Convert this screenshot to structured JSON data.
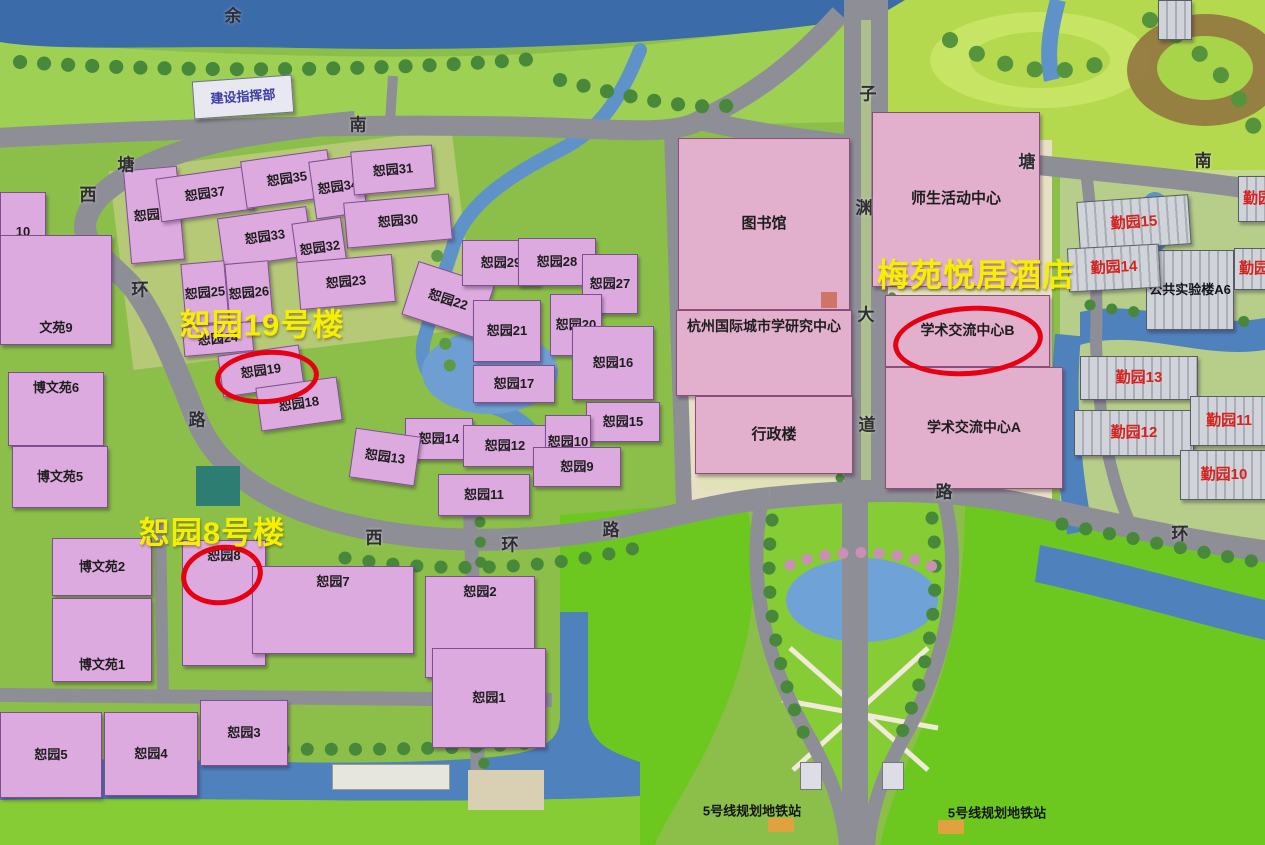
{
  "map": {
    "colors": {
      "highlight_text": "#f7ef00",
      "circle_stroke": "#e60012",
      "qinyuan_label": "#d6231f",
      "blue_label": "#3d3da8",
      "building_pink": "#dcaade",
      "building_civic": "#e2afcd",
      "water": "#4a7ab5",
      "road": "#8e8e96",
      "lawn": "#6cc81e"
    },
    "annotations": {
      "highlights": [
        {
          "n": "highlight-shuyuan-19-building",
          "t": "恕园19号楼",
          "x": 262,
          "y": 322,
          "fs": 31
        },
        {
          "n": "highlight-shuyuan-8-building",
          "t": "恕园8号楼",
          "x": 212,
          "y": 530,
          "fs": 31
        },
        {
          "n": "highlight-meiyuan-yueju-hotel",
          "t": "梅苑悦居酒店",
          "x": 976,
          "y": 273,
          "fs": 32
        }
      ],
      "circles": [
        {
          "n": "circle-shuyuan-19",
          "cx": 262,
          "cy": 372,
          "rx": 47,
          "ry": 22,
          "r": -4
        },
        {
          "n": "circle-shuyuan-8",
          "cx": 217,
          "cy": 570,
          "rx": 36,
          "ry": 25,
          "r": -8
        },
        {
          "n": "circle-academic-exchange-center-b",
          "cx": 963,
          "cy": 336,
          "rx": 70,
          "ry": 30,
          "r": -4
        }
      ]
    },
    "buildings": [
      {
        "n": "jianshe-zhihuibu",
        "l": "建设指挥部",
        "x": 193,
        "y": 78,
        "w": 100,
        "h": 38,
        "r": -4,
        "s": "white",
        "lc": "#3d3da8",
        "fs": 13
      },
      {
        "n": "shuyuan-36",
        "l": "恕园36",
        "x": 127,
        "y": 168,
        "w": 54,
        "h": 94,
        "r": -5,
        "s": "pink"
      },
      {
        "n": "shuyuan-37",
        "l": "恕园37",
        "x": 158,
        "y": 172,
        "w": 94,
        "h": 44,
        "r": -8,
        "s": "pink"
      },
      {
        "n": "shuyuan-35",
        "l": "恕园35",
        "x": 243,
        "y": 155,
        "w": 88,
        "h": 48,
        "r": -8,
        "s": "pink"
      },
      {
        "n": "shuyuan-34",
        "l": "恕园34",
        "x": 312,
        "y": 158,
        "w": 52,
        "h": 58,
        "r": -8,
        "s": "pink"
      },
      {
        "n": "shuyuan-31",
        "l": "恕园31",
        "x": 352,
        "y": 148,
        "w": 82,
        "h": 44,
        "r": -5,
        "s": "pink"
      },
      {
        "n": "shuyuan-30",
        "l": "恕园30",
        "x": 345,
        "y": 198,
        "w": 106,
        "h": 46,
        "r": -5,
        "s": "pink"
      },
      {
        "n": "shuyuan-33",
        "l": "恕园33",
        "x": 220,
        "y": 212,
        "w": 90,
        "h": 50,
        "r": -8,
        "s": "pink"
      },
      {
        "n": "shuyuan-32",
        "l": "恕园32",
        "x": 295,
        "y": 220,
        "w": 50,
        "h": 56,
        "r": -8,
        "s": "pink"
      },
      {
        "n": "shuyuan-25",
        "l": "恕园25",
        "x": 183,
        "y": 262,
        "w": 44,
        "h": 62,
        "r": -5,
        "s": "pink"
      },
      {
        "n": "shuyuan-26",
        "l": "恕园26",
        "x": 227,
        "y": 262,
        "w": 44,
        "h": 62,
        "r": -5,
        "s": "pink"
      },
      {
        "n": "shuyuan-23",
        "l": "恕园23",
        "x": 298,
        "y": 258,
        "w": 96,
        "h": 48,
        "r": -5,
        "s": "pink"
      },
      {
        "n": "shuyuan-22",
        "l": "恕园22",
        "x": 408,
        "y": 272,
        "w": 80,
        "h": 56,
        "r": 18,
        "s": "pink"
      },
      {
        "n": "shuyuan-24",
        "l": "恕园24",
        "x": 183,
        "y": 324,
        "w": 70,
        "h": 30,
        "r": -5,
        "s": "pink"
      },
      {
        "n": "shuyuan-19",
        "l": "恕园19",
        "x": 220,
        "y": 350,
        "w": 82,
        "h": 42,
        "r": -8,
        "s": "pink"
      },
      {
        "n": "shuyuan-18",
        "l": "恕园18",
        "x": 258,
        "y": 382,
        "w": 82,
        "h": 44,
        "r": -8,
        "s": "pink"
      },
      {
        "n": "shuyuan-29",
        "l": "恕园29",
        "x": 462,
        "y": 240,
        "w": 78,
        "h": 46,
        "r": 0,
        "s": "pink"
      },
      {
        "n": "shuyuan-28",
        "l": "恕园28",
        "x": 518,
        "y": 238,
        "w": 78,
        "h": 48,
        "r": 0,
        "s": "pink"
      },
      {
        "n": "shuyuan-27",
        "l": "恕园27",
        "x": 582,
        "y": 254,
        "w": 56,
        "h": 60,
        "r": 0,
        "s": "pink"
      },
      {
        "n": "shuyuan-21",
        "l": "恕园21",
        "x": 473,
        "y": 300,
        "w": 68,
        "h": 62,
        "r": 0,
        "s": "pink"
      },
      {
        "n": "shuyuan-20",
        "l": "恕园20",
        "x": 550,
        "y": 294,
        "w": 52,
        "h": 62,
        "r": 0,
        "s": "pink"
      },
      {
        "n": "shuyuan-16",
        "l": "恕园16",
        "x": 572,
        "y": 326,
        "w": 82,
        "h": 74,
        "r": 0,
        "s": "pink"
      },
      {
        "n": "shuyuan-17",
        "l": "恕园17",
        "x": 473,
        "y": 365,
        "w": 82,
        "h": 38,
        "r": 0,
        "s": "pink"
      },
      {
        "n": "shuyuan-15",
        "l": "恕园15",
        "x": 586,
        "y": 402,
        "w": 74,
        "h": 40,
        "r": 0,
        "s": "pink"
      },
      {
        "n": "shuyuan-14",
        "l": "恕园14",
        "x": 405,
        "y": 418,
        "w": 68,
        "h": 42,
        "r": 0,
        "s": "pink"
      },
      {
        "n": "shuyuan-13",
        "l": "恕园13",
        "x": 352,
        "y": 432,
        "w": 66,
        "h": 50,
        "r": 8,
        "s": "pink"
      },
      {
        "n": "shuyuan-12",
        "l": "恕园12",
        "x": 463,
        "y": 425,
        "w": 84,
        "h": 42,
        "r": 0,
        "s": "pink"
      },
      {
        "n": "shuyuan-10",
        "l": "恕园10",
        "x": 545,
        "y": 415,
        "w": 46,
        "h": 54,
        "r": 0,
        "s": "pink"
      },
      {
        "n": "shuyuan-9",
        "l": "恕园9",
        "x": 533,
        "y": 447,
        "w": 88,
        "h": 40,
        "r": 0,
        "s": "pink"
      },
      {
        "n": "shuyuan-11",
        "l": "恕园11",
        "x": 438,
        "y": 474,
        "w": 92,
        "h": 42,
        "r": 0,
        "s": "pink"
      },
      {
        "n": "bowenyuan-10-partial",
        "l": "10",
        "x": 0,
        "y": 192,
        "w": 46,
        "h": 80,
        "r": 0,
        "s": "pink"
      },
      {
        "n": "bowenyuan-9",
        "l": "文苑9",
        "x": 0,
        "y": 235,
        "w": 112,
        "h": 110,
        "r": 0,
        "s": "pink",
        "lp": "b"
      },
      {
        "n": "bowenyuan-6",
        "l": "博文苑6",
        "x": 8,
        "y": 372,
        "w": 96,
        "h": 74,
        "r": 0,
        "s": "pink",
        "lp": "t"
      },
      {
        "n": "bowenyuan-5",
        "l": "博文苑5",
        "x": 12,
        "y": 446,
        "w": 96,
        "h": 62,
        "r": 0,
        "s": "pink"
      },
      {
        "n": "bowenyuan-2",
        "l": "博文苑2",
        "x": 52,
        "y": 538,
        "w": 100,
        "h": 58,
        "r": 0,
        "s": "pink"
      },
      {
        "n": "bowenyuan-1",
        "l": "博文苑1",
        "x": 52,
        "y": 598,
        "w": 100,
        "h": 84,
        "r": 0,
        "s": "pink",
        "lp": "b"
      },
      {
        "n": "shuyuan-8",
        "l": "恕园8",
        "x": 182,
        "y": 540,
        "w": 84,
        "h": 126,
        "r": 0,
        "s": "pink",
        "lp": "t"
      },
      {
        "n": "shuyuan-7",
        "l": "恕园7",
        "x": 252,
        "y": 566,
        "w": 162,
        "h": 88,
        "r": 0,
        "s": "pink",
        "lp": "t"
      },
      {
        "n": "shuyuan-5",
        "l": "恕园5",
        "x": 0,
        "y": 712,
        "w": 102,
        "h": 86,
        "r": 0,
        "s": "pink"
      },
      {
        "n": "shuyuan-4",
        "l": "恕园4",
        "x": 104,
        "y": 712,
        "w": 94,
        "h": 84,
        "r": 0,
        "s": "pink"
      },
      {
        "n": "shuyuan-3",
        "l": "恕园3",
        "x": 200,
        "y": 700,
        "w": 88,
        "h": 66,
        "r": 0,
        "s": "pink"
      },
      {
        "n": "shuyuan-2",
        "l": "恕园2",
        "x": 425,
        "y": 576,
        "w": 110,
        "h": 102,
        "r": 0,
        "s": "pink",
        "lp": "t"
      },
      {
        "n": "shuyuan-1",
        "l": "恕园1",
        "x": 432,
        "y": 648,
        "w": 114,
        "h": 100,
        "r": 0,
        "s": "pink"
      },
      {
        "n": "library",
        "l": "图书馆",
        "x": 678,
        "y": 138,
        "w": 172,
        "h": 172,
        "r": 0,
        "s": "civic",
        "fs": 15
      },
      {
        "n": "hangzhou-urban-studies-center",
        "l": "杭州国际城市学研究中心",
        "x": 676,
        "y": 310,
        "w": 176,
        "h": 86,
        "r": 0,
        "s": "civic",
        "lp": "t",
        "fs": 14,
        "nw": true
      },
      {
        "n": "admin-building",
        "l": "行政楼",
        "x": 695,
        "y": 396,
        "w": 158,
        "h": 78,
        "r": 0,
        "s": "civic",
        "fs": 15
      },
      {
        "n": "student-activity-center",
        "l": "师生活动中心",
        "x": 872,
        "y": 112,
        "w": 168,
        "h": 175,
        "r": 0,
        "s": "civic",
        "fs": 15,
        "nw": true
      },
      {
        "n": "academic-exchange-center-b",
        "l": "学术交流中心B",
        "x": 885,
        "y": 295,
        "w": 165,
        "h": 72,
        "r": 0,
        "s": "civic",
        "fs": 14,
        "nw": true
      },
      {
        "n": "academic-exchange-center-a",
        "l": "学术交流中心A",
        "x": 885,
        "y": 367,
        "w": 178,
        "h": 122,
        "r": 0,
        "s": "civic",
        "fs": 14,
        "nw": true
      },
      {
        "n": "public-lab-a6",
        "l": "公共实验楼A6",
        "x": 1146,
        "y": 250,
        "w": 88,
        "h": 80,
        "r": 0,
        "s": "gray",
        "fs": 13,
        "nw": true
      },
      {
        "n": "qinyuan-15",
        "l": "勤园15",
        "x": 1078,
        "y": 198,
        "w": 112,
        "h": 50,
        "r": -4,
        "s": "gray",
        "lc": "#d6231f",
        "fs": 15
      },
      {
        "n": "qinyuan-14",
        "l": "勤园14",
        "x": 1068,
        "y": 246,
        "w": 92,
        "h": 44,
        "r": -3,
        "s": "gray",
        "lc": "#d6231f",
        "fs": 15
      },
      {
        "n": "qinyuan-13",
        "l": "勤园13",
        "x": 1080,
        "y": 356,
        "w": 118,
        "h": 44,
        "r": 0,
        "s": "gray",
        "lc": "#d6231f",
        "fs": 15
      },
      {
        "n": "qinyuan-12",
        "l": "勤园12",
        "x": 1074,
        "y": 410,
        "w": 120,
        "h": 46,
        "r": 0,
        "s": "gray",
        "lc": "#d6231f",
        "fs": 15
      },
      {
        "n": "qinyuan-11",
        "l": "勤园11",
        "x": 1190,
        "y": 396,
        "w": 78,
        "h": 50,
        "r": 0,
        "s": "gray",
        "lc": "#d6231f",
        "fs": 15
      },
      {
        "n": "qinyuan-10",
        "l": "勤园10",
        "x": 1180,
        "y": 450,
        "w": 88,
        "h": 50,
        "r": 0,
        "s": "gray",
        "lc": "#d6231f",
        "fs": 15
      },
      {
        "n": "qinyuan-partial-upper",
        "l": "勤园",
        "x": 1238,
        "y": 176,
        "w": 40,
        "h": 46,
        "r": 0,
        "s": "gray",
        "lc": "#d6231f",
        "fs": 15
      },
      {
        "n": "qinyuan-partial-lower",
        "l": "勤园",
        "x": 1234,
        "y": 248,
        "w": 40,
        "h": 42,
        "r": 0,
        "s": "gray",
        "lc": "#d6231f",
        "fs": 15
      },
      {
        "n": "small-building-topright",
        "l": "",
        "x": 1158,
        "y": 0,
        "w": 34,
        "h": 40,
        "r": 0,
        "s": "gray"
      }
    ],
    "road_labels": [
      {
        "n": "river-label-yu",
        "t": "余",
        "x": 233,
        "y": 14
      },
      {
        "n": "road-label-nan-west",
        "t": "南",
        "x": 358,
        "y": 123
      },
      {
        "n": "road-label-tang-west",
        "t": "塘",
        "x": 126,
        "y": 163
      },
      {
        "n": "road-label-xi-nw",
        "t": "西",
        "x": 88,
        "y": 193
      },
      {
        "n": "road-label-huan-nw",
        "t": "环",
        "x": 140,
        "y": 288
      },
      {
        "n": "road-label-lu-nw",
        "t": "路",
        "x": 197,
        "y": 418
      },
      {
        "n": "road-label-xi-south",
        "t": "西",
        "x": 374,
        "y": 536
      },
      {
        "n": "road-label-huan-south",
        "t": "环",
        "x": 510,
        "y": 543
      },
      {
        "n": "road-label-lu-south",
        "t": "路",
        "x": 611,
        "y": 528
      },
      {
        "n": "road-label-lu-southeast",
        "t": "路",
        "x": 944,
        "y": 490
      },
      {
        "n": "road-label-huan-east",
        "t": "环",
        "x": 1180,
        "y": 532
      },
      {
        "n": "road-label-zi",
        "t": "子",
        "x": 868,
        "y": 92
      },
      {
        "n": "road-label-yuan",
        "t": "渊",
        "x": 864,
        "y": 206
      },
      {
        "n": "road-label-da",
        "t": "大",
        "x": 866,
        "y": 313
      },
      {
        "n": "road-label-dao",
        "t": "道",
        "x": 867,
        "y": 423
      },
      {
        "n": "road-label-tang-east",
        "t": "塘",
        "x": 1027,
        "y": 160
      },
      {
        "n": "road-label-nan-east",
        "t": "南",
        "x": 1203,
        "y": 159
      }
    ],
    "stations": [
      {
        "n": "metro-station-label-left",
        "t": "5号线规划地铁站",
        "x": 752,
        "y": 810
      },
      {
        "n": "metro-station-label-right",
        "t": "5号线规划地铁站",
        "x": 997,
        "y": 812
      }
    ]
  }
}
